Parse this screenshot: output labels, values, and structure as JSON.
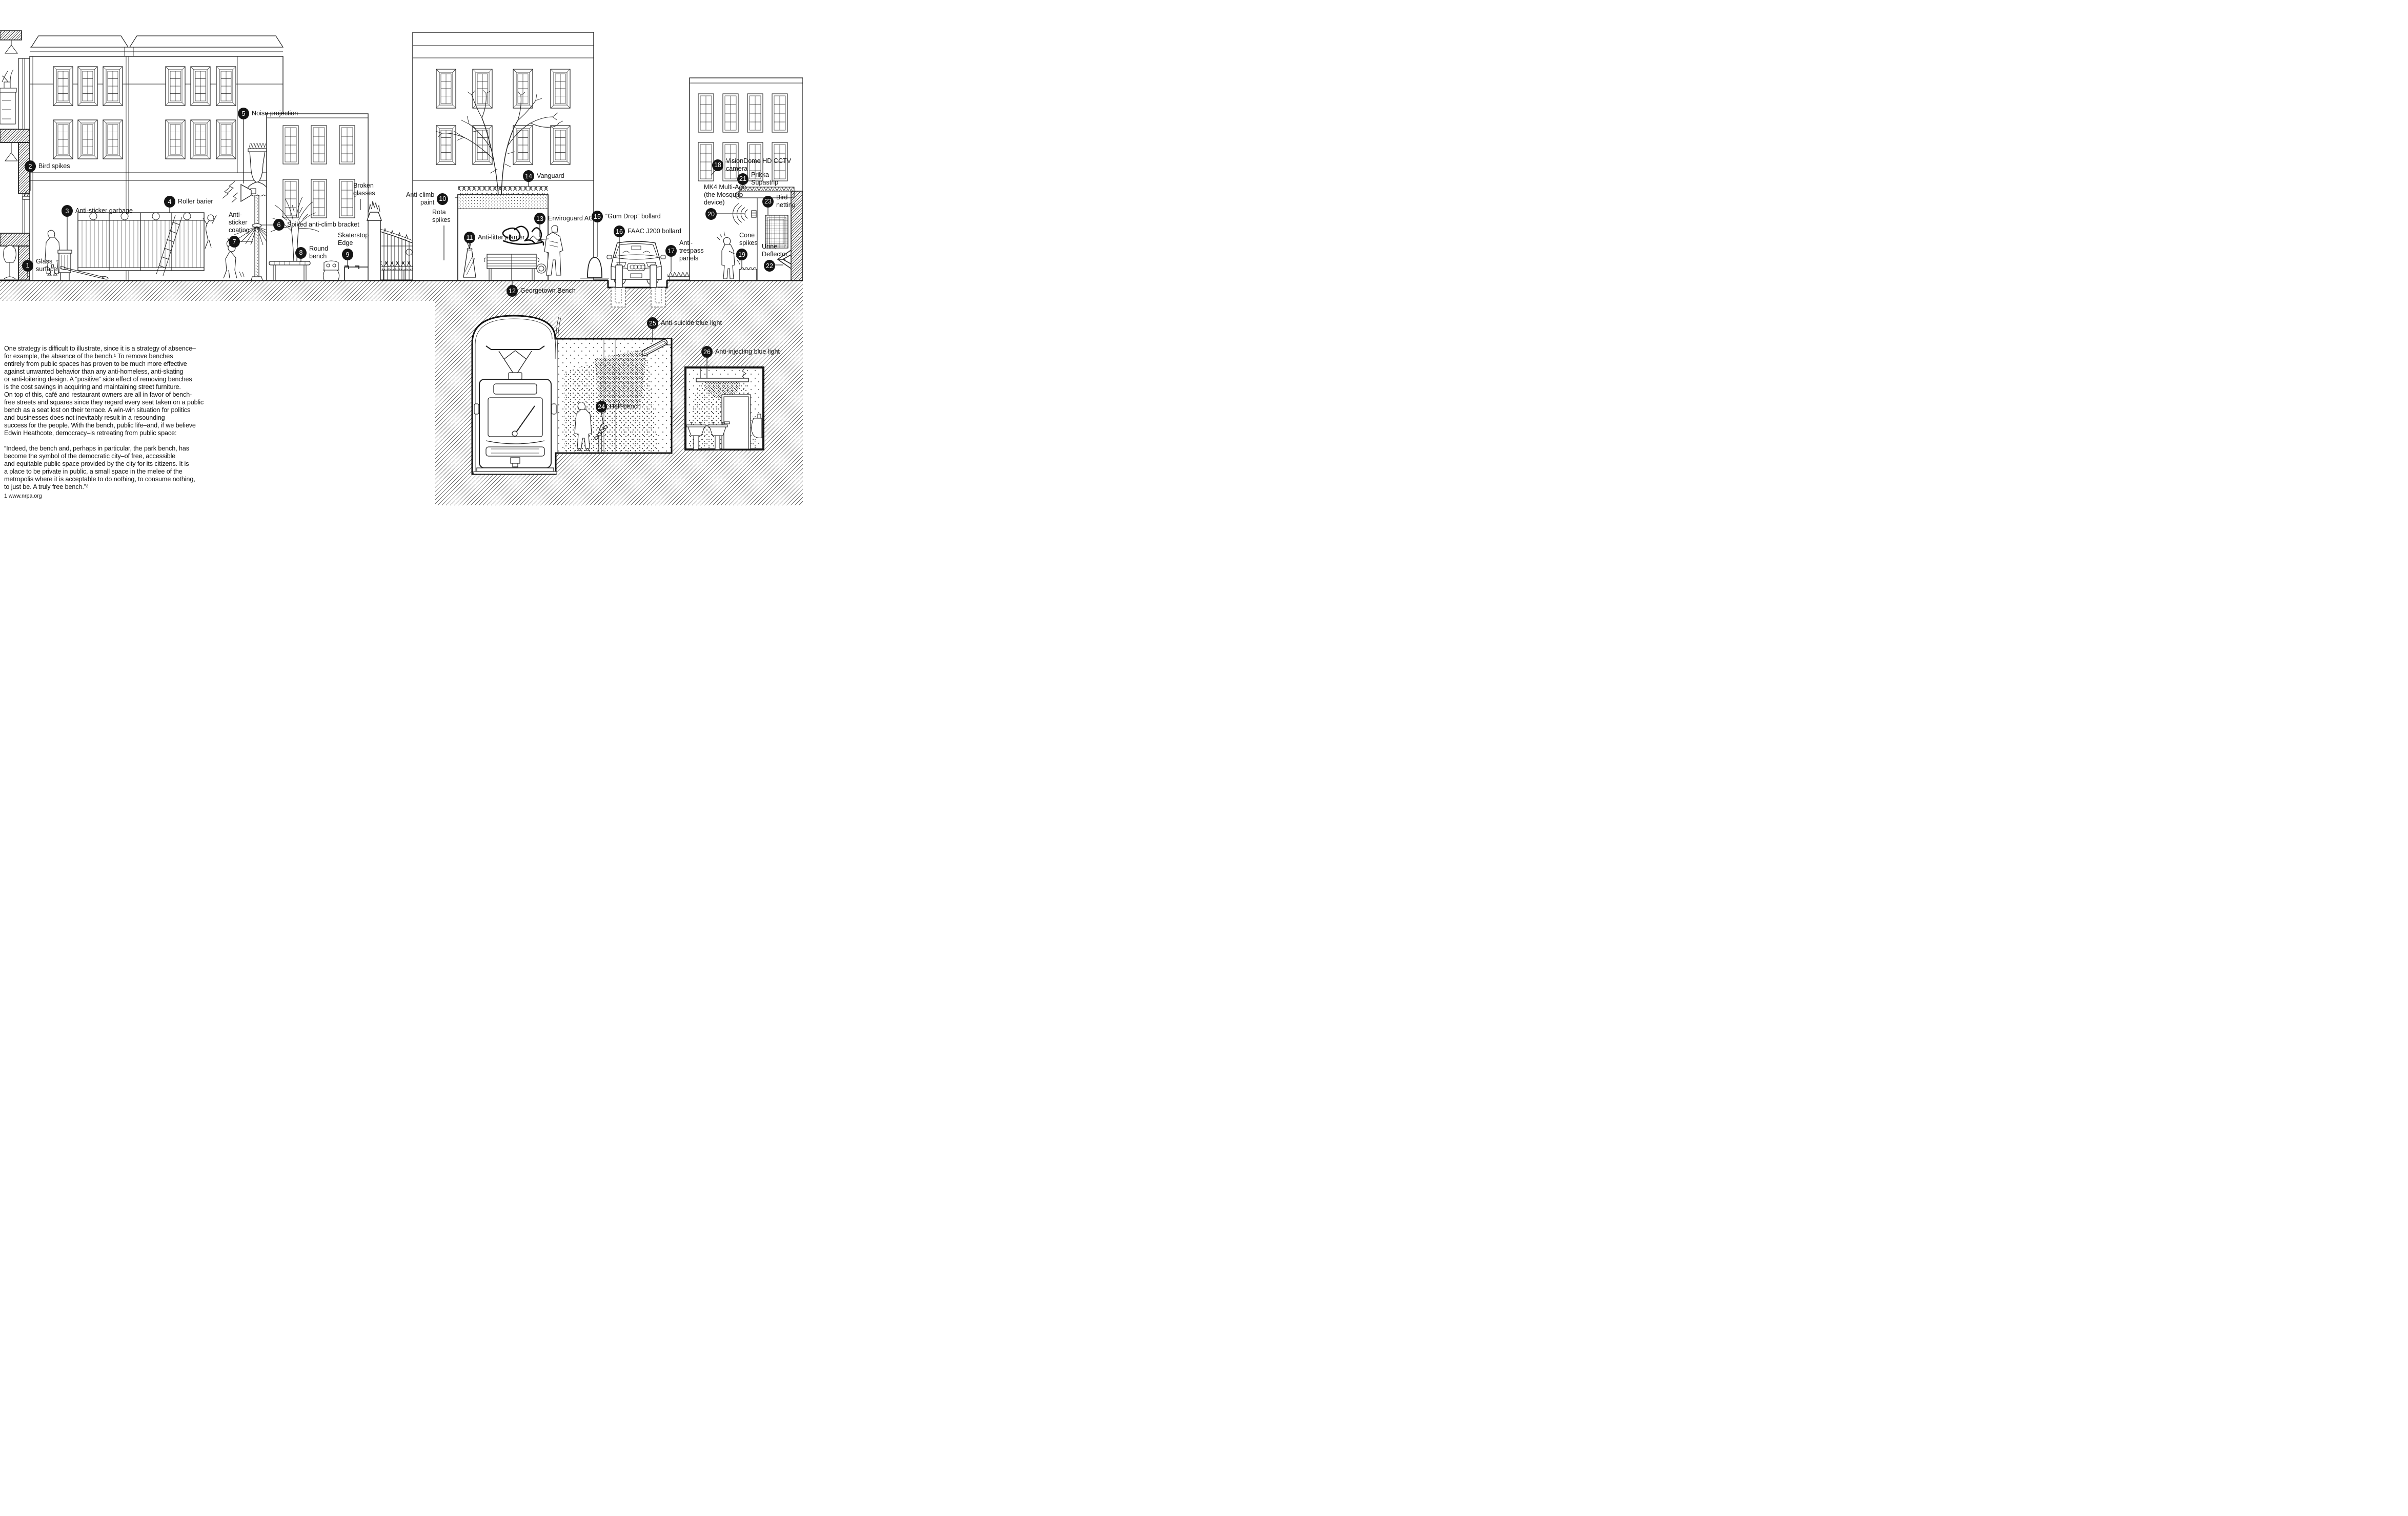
{
  "meta": {
    "type": "street-elevation-diagram",
    "subject": "Defensive / hostile architecture elements in public space",
    "ink_color": "#141414",
    "paper_color": "#ffffff"
  },
  "callouts": [
    {
      "n": "1",
      "label": "Glass\nsurface"
    },
    {
      "n": "2",
      "label": "Bird spikes"
    },
    {
      "n": "3",
      "label": "Anti-sticker garbage"
    },
    {
      "n": "4",
      "label": "Roller barier"
    },
    {
      "n": "5",
      "label": "Noise projection"
    },
    {
      "n": "6",
      "label": "Spiked anti-climb bracket"
    },
    {
      "n": "7",
      "label": "Anti-\nsticker\ncoating"
    },
    {
      "n": "8",
      "label": "Round\nbench"
    },
    {
      "n": "9",
      "label": "Skaterstop\nEdge"
    },
    {
      "n": "10",
      "label": "Anti-climb\npaint"
    },
    {
      "n": "11",
      "label": "Anti-litter planter"
    },
    {
      "n": "12",
      "label": "Georgetown Bench"
    },
    {
      "n": "13",
      "label": "Enviroguard AG"
    },
    {
      "n": "14",
      "label": "Vanguard"
    },
    {
      "n": "15",
      "label": "“Gum Drop” bollard"
    },
    {
      "n": "16",
      "label": "FAAC J200 bollard"
    },
    {
      "n": "17",
      "label": "Anti-\ntrespass\npanels"
    },
    {
      "n": "18",
      "label": "VisionDome HD CCTV camera"
    },
    {
      "n": "19",
      "label": "Cone\nspikes"
    },
    {
      "n": "20",
      "label": "MK4 Multi-Age\n(the Mosquito\ndevice)"
    },
    {
      "n": "21",
      "label": "Prikka\nSupastrip"
    },
    {
      "n": "22",
      "label": "Urine\nDeflector"
    },
    {
      "n": "23",
      "label": "Bird\nnetting"
    },
    {
      "n": "24",
      "label": "Half-bench"
    },
    {
      "n": "25",
      "label": "Anti-suicide blue light"
    },
    {
      "n": "26",
      "label": "Anti-injecting blue light"
    }
  ],
  "annotations": [
    {
      "label": "Broken\nglasses"
    },
    {
      "label": "Rota\nspikes"
    }
  ],
  "essay": {
    "paragraph": "One strategy is difficult to illustrate, since it is a strategy of absence–\nfor example, the absence of the bench.¹ To remove benches\nentirely from public spaces has proven to be much more effective\nagainst unwanted behavior than any anti-homeless, anti-skating\nor anti-loitering design. A “positive” side effect of removing benches\nis the cost savings in acquiring and maintaining street furniture.\nOn top of this, café and restaurant owners are all in favor of bench-\nfree streets and squares since they regard every seat taken on a public\nbench as a seat lost on their terrace. A win-win situation for politics\nand businesses does not inevitably result in a resounding\nsuccess for the people. With the bench, public life–and, if we believe\nEdwin Heathcote, democracy–is retreating from public space:",
    "quote": "“Indeed, the bench and, perhaps in particular, the park bench, has\nbecome the symbol of the democratic city–of free, accessible\nand equitable public space provided by the city for its citizens. It is\na place to be private in public, a small space in the melee of the\nmetropolis where it is acceptable to do nothing, to consume nothing,\nto just be. A truly free bench.”²",
    "footnote1": "1  www.nrpa.org",
    "footnote2_pre": "2  Edwin Heathcote, in “Public Benches: The Seat of Civilization,” ",
    "footnote2_italic": "Financial Times",
    "footnote2_post": ",\nJune 19, 2015, www.ft.com"
  }
}
